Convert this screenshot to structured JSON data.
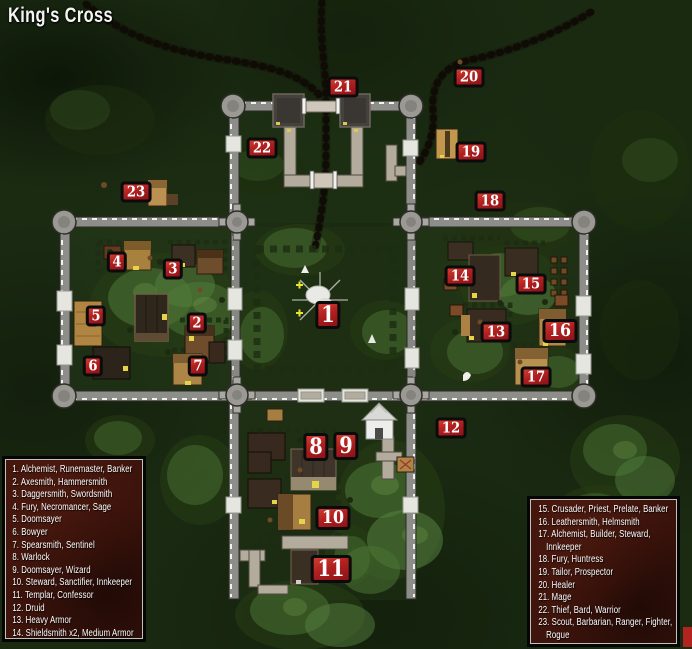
{
  "title": "King's Cross",
  "legend_left": {
    "items": [
      "1. Alchemist, Runemaster, Banker",
      "2. Axesmith, Hammersmith",
      "3. Daggersmith, Swordsmith",
      "4. Fury, Necromancer, Sage",
      "5. Doomsayer",
      "6. Bowyer",
      "7. Spearsmith, Sentinel",
      "8. Warlock",
      "9. Doomsayer, Wizard",
      "10. Steward, Sanctifier, Innkeeper",
      "11. Templar, Confessor",
      "12. Druid",
      "13. Heavy Armor",
      "14. Shieldsmith x2, Medium Armor"
    ]
  },
  "legend_right": {
    "items": [
      "15. Crusader, Priest, Prelate, Banker",
      "16. Leathersmith, Helmsmith",
      "17. Alchemist, Builder, Steward, Innkeeper",
      "18. Fury, Huntress",
      "19. Tailor, Prospector",
      "20. Healer",
      "21. Mage",
      "22. Thief, Bard, Warrior",
      "23. Scout, Barbarian, Ranger, Fighter, Rogue"
    ]
  },
  "markers": [
    "1",
    "2",
    "3",
    "4",
    "5",
    "6",
    "7",
    "8",
    "9",
    "10",
    "11",
    "12",
    "13",
    "14",
    "15",
    "16",
    "17",
    "18",
    "19",
    "20",
    "21",
    "22",
    "23"
  ],
  "colors": {
    "marker_red": "#b5201f",
    "wall_gray": "#8d8d8a",
    "legend_bg": "#38120b",
    "forest_green": "#1b2b12"
  }
}
